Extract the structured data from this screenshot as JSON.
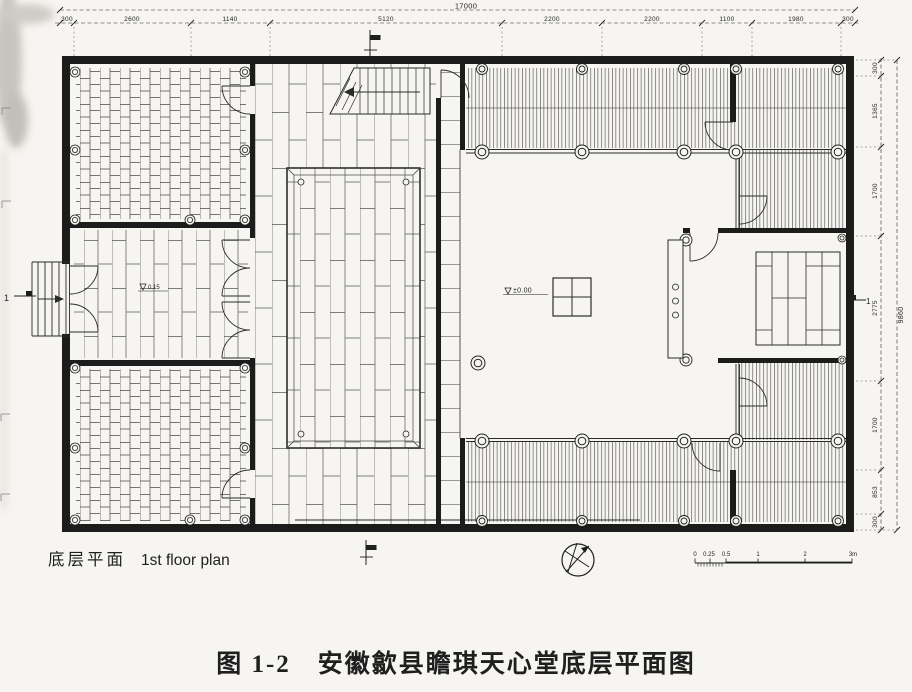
{
  "figure": {
    "plan_label_cn": "底层平面",
    "plan_label_en": "1st floor plan",
    "caption": "图 1-2　安徽歙县瞻琪天心堂底层平面图"
  },
  "levels": {
    "courtyard": "±0.00",
    "entry": "0.15"
  },
  "dimensions": {
    "top": {
      "overall": "17000",
      "segments": [
        "300",
        "2600",
        "1140",
        "5120",
        "2200",
        "2200",
        "1100",
        "1980",
        "300"
      ]
    },
    "right": {
      "overall": "9860",
      "segments": [
        "300",
        "1365",
        "1700",
        "2775",
        "1700",
        "853",
        "300"
      ]
    },
    "scale_bar": [
      "0",
      "0.25",
      "0.5",
      "1",
      "2",
      "3m"
    ]
  },
  "markers": {
    "section_left": "1",
    "section_right": "1"
  }
}
